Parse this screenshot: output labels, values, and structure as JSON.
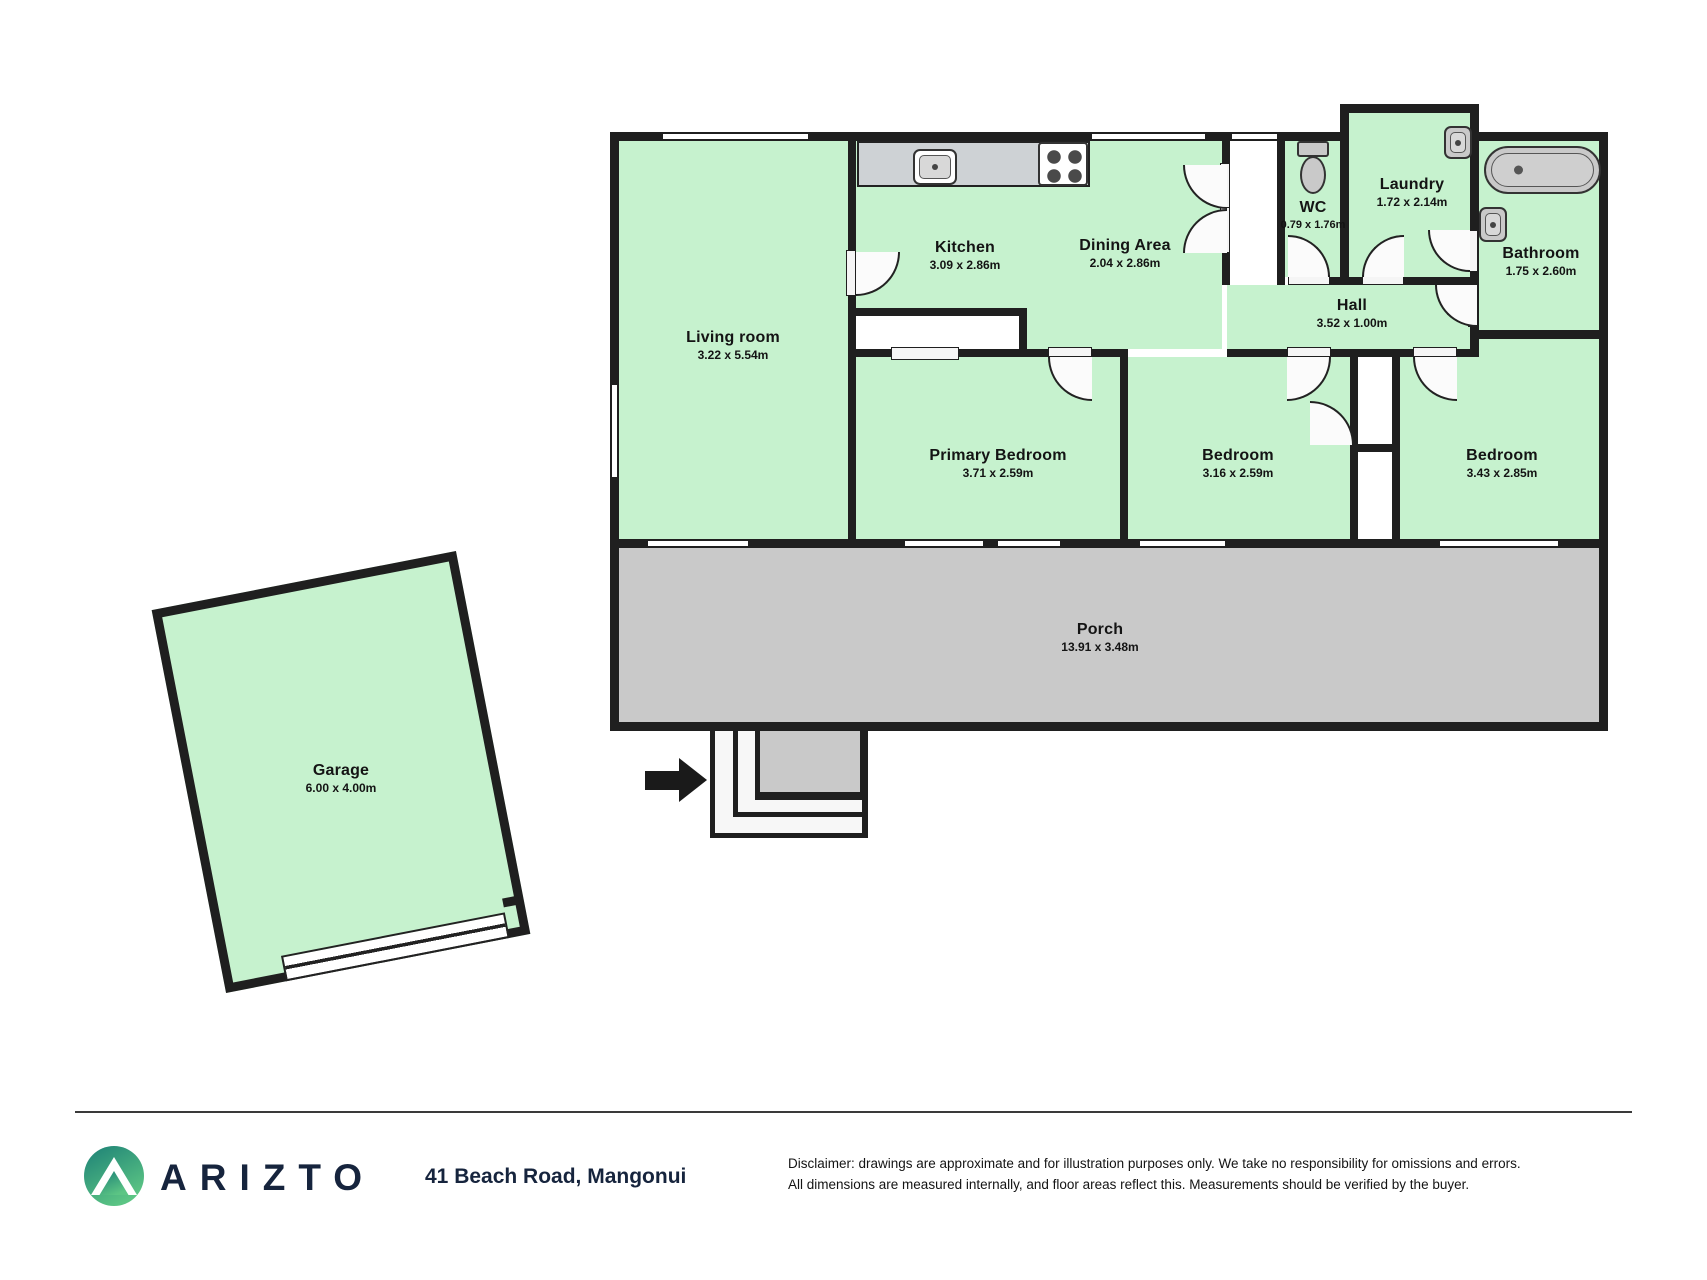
{
  "rooms": {
    "living_room": {
      "name": "Living room",
      "dims": "3.22 x 5.54m"
    },
    "kitchen": {
      "name": "Kitchen",
      "dims": "3.09 x 2.86m"
    },
    "dining_area": {
      "name": "Dining Area",
      "dims": "2.04 x 2.86m"
    },
    "wc": {
      "name": "WC",
      "dims": "0.79 x 1.76m"
    },
    "laundry": {
      "name": "Laundry",
      "dims": "1.72 x 2.14m"
    },
    "bathroom": {
      "name": "Bathroom",
      "dims": "1.75 x 2.60m"
    },
    "hall": {
      "name": "Hall",
      "dims": "3.52 x 1.00m"
    },
    "primary_bedroom": {
      "name": "Primary Bedroom",
      "dims": "3.71 x 2.59m"
    },
    "bedroom_mid": {
      "name": "Bedroom",
      "dims": "3.16 x 2.59m"
    },
    "bedroom_right": {
      "name": "Bedroom",
      "dims": "3.43 x 2.85m"
    },
    "porch": {
      "name": "Porch",
      "dims": "13.91 x 3.48m"
    },
    "garage": {
      "name": "Garage",
      "dims": "6.00 x 4.00m"
    }
  },
  "icons": {
    "entry_arrow": "entry-arrow-icon",
    "kitchen_sink": "kitchen-sink-icon",
    "stove": "stove-icon",
    "toilet": "toilet-icon",
    "laundry_sink": "laundry-sink-icon",
    "bathroom_sink": "bathroom-sink-icon",
    "bathtub": "bathtub-icon",
    "logo_mountain": "mountain-icon"
  },
  "footer": {
    "brand": "ARIZTO",
    "address": "41 Beach Road, Mangonui",
    "disclaimer_line1": "Disclaimer: drawings are approximate and for illustration purposes only. We take no responsibility for omissions and errors.",
    "disclaimer_line2": "All dimensions are measured internally, and floor areas reflect this. Measurements should be verified by the buyer."
  },
  "colors": {
    "room_fill": "#c6f2ce",
    "porch_fill": "#c9c9c9",
    "counter_fill": "#ced2d5",
    "wall": "#1f1f1f",
    "brand_navy": "#16243d",
    "logo_teal": "#1c8076",
    "logo_green": "#5cc584"
  }
}
